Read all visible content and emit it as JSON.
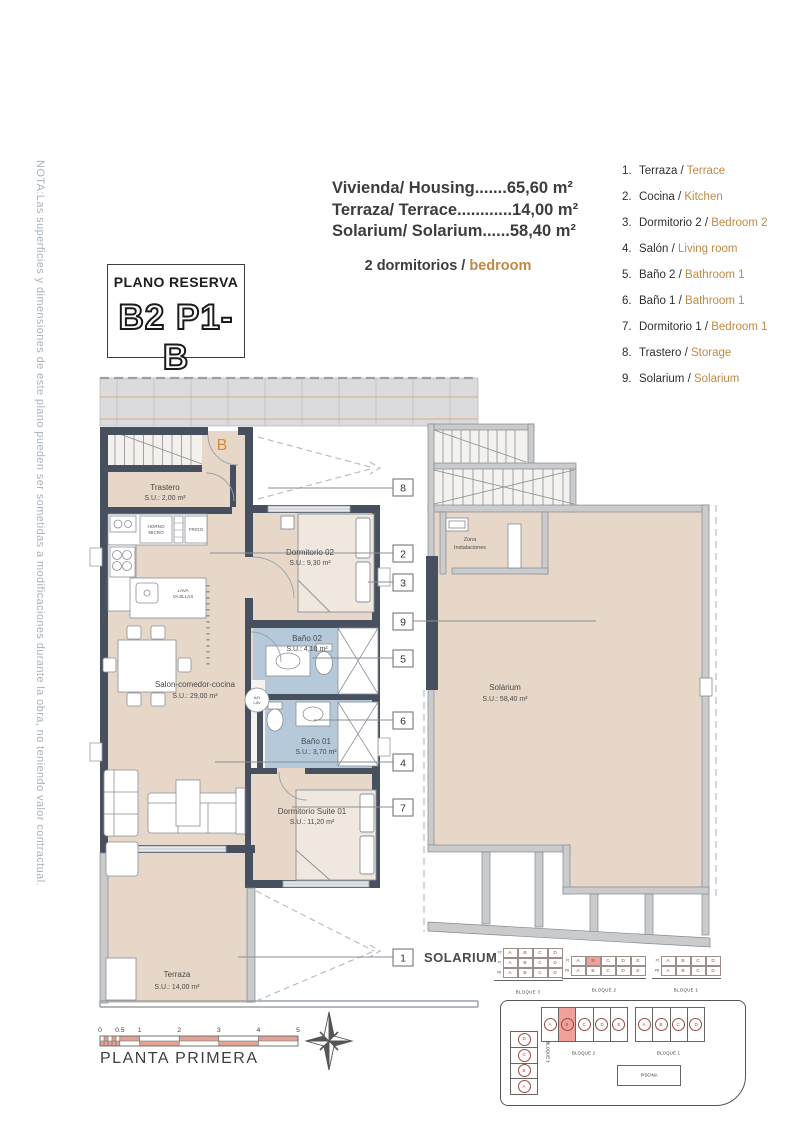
{
  "note": "NOTA:Las superficies y dimensiones de este plano pueden ser sometidas a modificaciones durante la obra, no teniendo valor contractual.",
  "header": {
    "areas": [
      "Vivienda/ Housing.......65,60 m²",
      "Terraza/ Terrace............14,00 m²",
      "Solarium/ Solarium......58,40 m²"
    ],
    "bedrooms_es": "2 dormitorios /",
    "bedrooms_en": "bedroom"
  },
  "title_box": {
    "label": "PLANO RESERVA",
    "code": "B2 P1-B"
  },
  "legend": {
    "items": [
      {
        "num": "1.",
        "es": "Terraza /",
        "en": "Terrace"
      },
      {
        "num": "2.",
        "es": "Cocina /",
        "en": "Kitchen"
      },
      {
        "num": "3.",
        "es": "Dormitorio 2 /",
        "en": "Bedroom 2"
      },
      {
        "num": "4.",
        "es": "Salón /",
        "en": "Living room"
      },
      {
        "num": "5.",
        "es": "Baño 2 /",
        "en": "Bathroom 1"
      },
      {
        "num": "6.",
        "es": "Baño 1 /",
        "en": "Bathroom 1"
      },
      {
        "num": "7.",
        "es": "Dormitorio 1 /",
        "en": "Bedroom 1"
      },
      {
        "num": "8.",
        "es": "Trastero /",
        "en": "Storage"
      },
      {
        "num": "9.",
        "es": "Solarium /",
        "en": "Solarium"
      }
    ]
  },
  "plan": {
    "unit_letter": "B",
    "rooms": {
      "trastero": {
        "name": "Trastero",
        "area": "S.U.: 2,00 m²"
      },
      "dorm2": {
        "name": "Dormitorio 02",
        "area": "S.U.: 9,30 m²"
      },
      "bano2": {
        "name": "Baño 02",
        "area": "S.U.: 4,10 m²"
      },
      "bano1": {
        "name": "Baño 01",
        "area": "S.U.: 3,70 m²"
      },
      "salon": {
        "name": "Salon-comedor-cocina",
        "area": "S.U.: 29,00 m²"
      },
      "suite": {
        "name": "Dormitorio Suite 01",
        "area": "S.U.: 11,20 m²"
      },
      "terraza": {
        "name": "Terraza",
        "area": "S.U.: 14,00 m²"
      }
    },
    "labels": {
      "horno1": "HORNO",
      "horno2": "MICRO",
      "frigo": "FRIGO",
      "lava1": "LAVA",
      "lava2": "VAJILLAS",
      "adlav1": "A/D",
      "adlav2": "LAV"
    },
    "callouts": [
      "8",
      "2",
      "3",
      "9",
      "5",
      "6",
      "4",
      "7",
      "1"
    ]
  },
  "solarium_plan": {
    "zona1": "Zona",
    "zona2": "Instalaciones",
    "name": "Solárium",
    "area": "S.U.: 58,40 m²"
  },
  "solarium_tables": {
    "title": "SOLARIUM",
    "blocks": [
      {
        "caption": "BLOQUE 3",
        "row_labels": [
          "P2",
          "P1",
          "PB"
        ],
        "rows": [
          [
            "A",
            "B",
            "C",
            "D"
          ],
          [
            "A",
            "B",
            "C",
            "D"
          ],
          [
            "A",
            "B",
            "C",
            "D"
          ]
        ]
      },
      {
        "caption": "BLOQUE 2",
        "row_labels": [
          "P1",
          "PB"
        ],
        "rows": [
          [
            "A",
            "B",
            "C",
            "D",
            "E"
          ],
          [
            "A",
            "B",
            "C",
            "D",
            "E"
          ]
        ],
        "highlight": "P1-B"
      },
      {
        "caption": "BLOQUE 1",
        "row_labels": [
          "P1",
          "PB"
        ],
        "rows": [
          [
            "A",
            "B",
            "C",
            "D"
          ],
          [
            "A",
            "B",
            "C",
            "D"
          ]
        ]
      }
    ]
  },
  "site_plan": {
    "bloque2": {
      "caption": "BLOQUE 2",
      "units": [
        "A",
        "B",
        "C",
        "D",
        "E"
      ],
      "highlight": "B"
    },
    "bloque1": {
      "caption": "BLOQUE 1",
      "units": [
        "A",
        "B",
        "C",
        "D"
      ]
    },
    "bloque3": {
      "caption": "BLOQUE 3",
      "units": [
        "D",
        "C",
        "B",
        "A"
      ]
    },
    "piscina": "PISCINA"
  },
  "footer": {
    "scale_ticks": [
      "0",
      "0.5",
      "1",
      "2",
      "3",
      "4",
      "5"
    ],
    "plan_title": "PLANTA PRIMERA"
  },
  "colors": {
    "accent": "#bf8a45",
    "floor": "#e7d7c9",
    "wall": "#46505e",
    "bath": "#b5c9da",
    "highlight": "#f0a29a",
    "unit_letter": "#d98c2b"
  }
}
